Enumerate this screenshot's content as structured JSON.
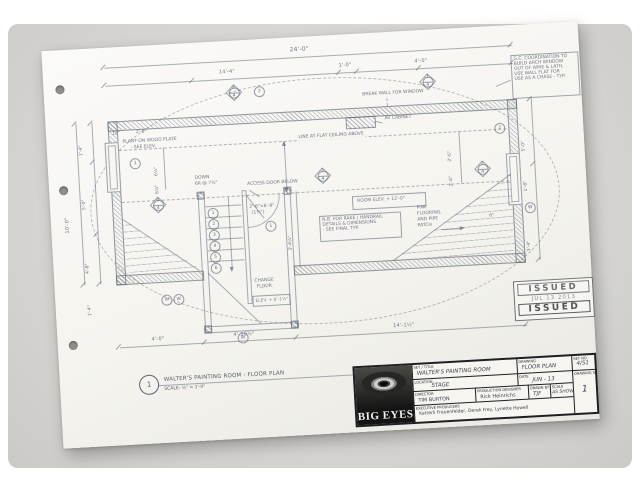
{
  "colors": {
    "pencil": "#6e7685",
    "ink": "#1d1f24",
    "paper": "#f5f4ef",
    "photo_bg": "#d7d6d3",
    "stamp": "#6f7276"
  },
  "plan": {
    "dims": {
      "top_overall": "24'-0\"",
      "top_left": "14'-4\"",
      "top_mid": "1'-0\"",
      "top_right": "4'-0\"",
      "left_outer": "10'-0\"",
      "left_top": "1'-4\"",
      "left_upper": "5'-0\"",
      "left_lower": "4'-8\"",
      "left_bottom": "1'-4\"",
      "right_upper": "5'-0\"",
      "right_mid": "1'-8\"",
      "right_lower": "3'-4\"",
      "bottom_left": "4'-0\"",
      "bottom_mid": "4'-10½\"",
      "bottom_right": "14'-1½\"",
      "int_offset": "12\"",
      "int_door": "2'-6\"",
      "int_stack_a": "6¼\"",
      "int_stack_b": "6¼\"",
      "int_right_a": "2'-6\"",
      "int_right_b": "2'-6\"",
      "stair_width": "3'-4¼\"",
      "tri_offset": "6\""
    },
    "notes": {
      "gc": [
        "G.C. COORDINATION TO",
        "BUILD ARCH WINDOW",
        "OUT OF WIRE & LATH,",
        "USE WALL FLAT FOR",
        "USE AS A CHASE - TYP."
      ],
      "break_wall": "BREAK WALL FOR WINDOW",
      "av_cabinet": "AV CABINET",
      "plant_on": [
        "PLANT-ON WOOD PLATE",
        "- SEE ELEV."
      ],
      "ceiling": "LINE AT FLAT CEILING ABOVE",
      "room_elev": "ROOM ELEV. + 12'-0\"",
      "nb": [
        "N.B. FOR RAKE / HANDRAIL",
        "DETAILS & DIMENSIONS",
        "- SEE FINAL   TYP."
      ],
      "pine": [
        "PINE",
        "FLOORING,",
        "AND PIPE",
        "PATCH"
      ],
      "access": "ACCESS DOOR BELOW",
      "down": [
        "DOWN",
        "6R @ 7¾\""
      ],
      "door_size": [
        "2'-6\"×6'-8\"",
        "(1¾\")"
      ],
      "change": [
        "CHANGE",
        "FLOOR"
      ],
      "elev8": "ELEV. + 8'-1½\""
    },
    "stair": {
      "treads": [
        "1",
        "2",
        "3",
        "4",
        "5",
        "6"
      ]
    },
    "markers": [
      {
        "top": "A",
        "bottom": "4"
      },
      {
        "top": "1",
        "bottom": "4"
      },
      {
        "top": "2",
        "bottom": "4"
      },
      {
        "top": "3",
        "bottom": "4"
      },
      {
        "top": "4",
        "bottom": "4"
      }
    ],
    "tags": {
      "top": "2",
      "wall_left": "1",
      "window_right": "2",
      "door": "1",
      "w1": "W",
      "w2": "W",
      "right": "W",
      "bottom": "W"
    }
  },
  "callout": {
    "number": "1",
    "title": "WALTER'S PAINTING ROOM - FLOOR PLAN",
    "scale": "SCALE: ½\" = 1'-0\""
  },
  "stamp": {
    "issued_top": "ISSUED",
    "date": "JUL 13 2013",
    "issued_bottom": "ISSUED"
  },
  "title_block": {
    "logo_text": "BIG EYES",
    "set_title_label": "SET / TITLE",
    "set_title": "WALTER'S PAINTING ROOM",
    "drawing_label": "DRAWING",
    "drawing": "FLOOR PLAN",
    "set_no_label": "SET NO.",
    "set_no": "4/51",
    "location_label": "LOCATION",
    "location": "STAGE",
    "date_label": "DATE",
    "date": "JUN - 13",
    "director_label": "DIRECTOR",
    "director": "TIM BURTON",
    "designer_label": "PRODUCTION DESIGNER",
    "designer": "Rick Heinrichs",
    "drawn_label": "DRAWN BY",
    "drawn": "TJF",
    "scale_label": "SCALE",
    "scale": "AS SHOWN",
    "producers_label": "EXECUTIVE PRODUCERS",
    "producers": "Katterli Frauenfelder, Derek Frey, Lynette Howell",
    "sheet_label": "DRAWING NO.",
    "sheet_no": "1"
  }
}
